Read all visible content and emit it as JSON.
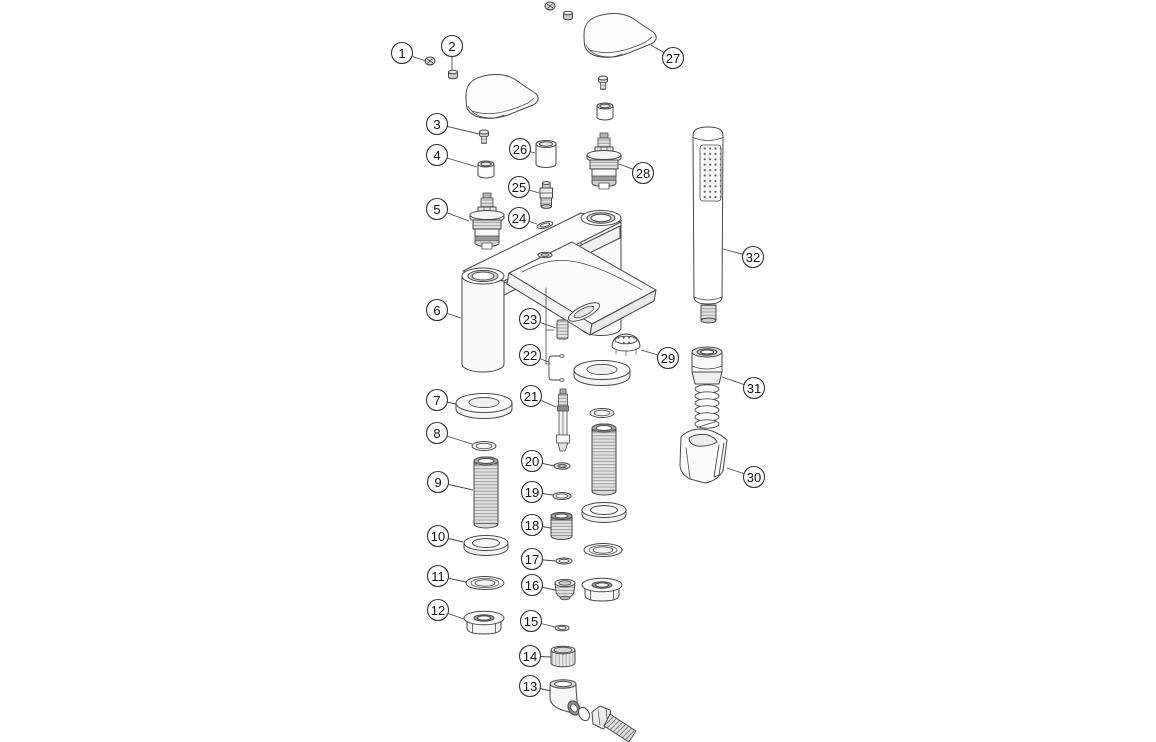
{
  "diagram": {
    "subject": "bath-shower-mixer-tap-exploded-parts-diagram",
    "background": "#ffffff",
    "line_color": "#474747",
    "callout_style": {
      "radius": 10.5,
      "fill": "#ffffff",
      "stroke": "#2e2e2e",
      "text_color": "#111111"
    },
    "callouts": [
      {
        "label": "1",
        "x": 402,
        "y": 53,
        "tx": 426,
        "ty": 61
      },
      {
        "label": "2",
        "x": 452,
        "y": 46,
        "tx": 452,
        "ty": 70
      },
      {
        "label": "3",
        "x": 437,
        "y": 124,
        "tx": 479,
        "ty": 134
      },
      {
        "label": "4",
        "x": 437,
        "y": 155,
        "tx": 477,
        "ty": 167
      },
      {
        "label": "5",
        "x": 437,
        "y": 209,
        "tx": 469,
        "ty": 221
      },
      {
        "label": "6",
        "x": 437,
        "y": 310,
        "tx": 461,
        "ty": 318
      },
      {
        "label": "7",
        "x": 437,
        "y": 400,
        "tx": 456,
        "ty": 404
      },
      {
        "label": "8",
        "x": 437,
        "y": 433,
        "tx": 472,
        "ty": 444
      },
      {
        "label": "9",
        "x": 438,
        "y": 482,
        "tx": 473,
        "ty": 490
      },
      {
        "label": "10",
        "x": 438,
        "y": 536,
        "tx": 463,
        "ty": 542
      },
      {
        "label": "11",
        "x": 438,
        "y": 576,
        "tx": 466,
        "ty": 582
      },
      {
        "label": "12",
        "x": 438,
        "y": 610,
        "tx": 464,
        "ty": 619
      },
      {
        "label": "13",
        "x": 530,
        "y": 686,
        "tx": 551,
        "ty": 691
      },
      {
        "label": "14",
        "x": 530,
        "y": 656,
        "tx": 551,
        "ty": 657
      },
      {
        "label": "15",
        "x": 531,
        "y": 621,
        "tx": 555,
        "ty": 627
      },
      {
        "label": "16",
        "x": 532,
        "y": 585,
        "tx": 555,
        "ty": 590
      },
      {
        "label": "17",
        "x": 532,
        "y": 559,
        "tx": 556,
        "ty": 561
      },
      {
        "label": "18",
        "x": 532,
        "y": 525,
        "tx": 551,
        "ty": 528
      },
      {
        "label": "19",
        "x": 532,
        "y": 492,
        "tx": 553,
        "ty": 495
      },
      {
        "label": "20",
        "x": 532,
        "y": 461,
        "tx": 554,
        "ty": 466
      },
      {
        "label": "21",
        "x": 531,
        "y": 396,
        "tx": 556,
        "ty": 407
      },
      {
        "label": "22",
        "x": 530,
        "y": 355,
        "tx": 549,
        "ty": 362
      },
      {
        "label": "23",
        "x": 530,
        "y": 319,
        "tx": 556,
        "ty": 328
      },
      {
        "label": "24",
        "x": 519,
        "y": 218,
        "tx": 537,
        "ty": 224
      },
      {
        "label": "25",
        "x": 519,
        "y": 187,
        "tx": 539,
        "ty": 193
      },
      {
        "label": "26",
        "x": 520,
        "y": 149,
        "tx": 535,
        "ty": 153
      },
      {
        "label": "27",
        "x": 673,
        "y": 58,
        "tx": 651,
        "ty": 45
      },
      {
        "label": "28",
        "x": 643,
        "y": 173,
        "tx": 619,
        "ty": 164
      },
      {
        "label": "29",
        "x": 668,
        "y": 358,
        "tx": 641,
        "ty": 350
      },
      {
        "label": "30",
        "x": 754,
        "y": 477,
        "tx": 727,
        "ty": 468
      },
      {
        "label": "31",
        "x": 754,
        "y": 388,
        "tx": 722,
        "ty": 377
      },
      {
        "label": "32",
        "x": 753,
        "y": 257,
        "tx": 723,
        "ty": 249
      }
    ],
    "parts": [
      {
        "callout": "1",
        "name": "grub-screw"
      },
      {
        "callout": "2",
        "name": "screw-bush"
      },
      {
        "callout": "3",
        "name": "handle-fixing-screw"
      },
      {
        "callout": "4",
        "name": "cartridge-cap"
      },
      {
        "callout": "5",
        "name": "ceramic-cartridge"
      },
      {
        "callout": "6",
        "name": "mixer-body"
      },
      {
        "callout": "7",
        "name": "base-washer"
      },
      {
        "callout": "8",
        "name": "o-ring"
      },
      {
        "callout": "9",
        "name": "threaded-shank"
      },
      {
        "callout": "10",
        "name": "rubber-washer"
      },
      {
        "callout": "11",
        "name": "flat-washer"
      },
      {
        "callout": "12",
        "name": "flanged-fixing-nut"
      },
      {
        "callout": "13",
        "name": "elbow-hose-tail"
      },
      {
        "callout": "14",
        "name": "cap-nut"
      },
      {
        "callout": "15",
        "name": "o-ring-small"
      },
      {
        "callout": "16",
        "name": "blanking-plug"
      },
      {
        "callout": "17",
        "name": "o-ring-small"
      },
      {
        "callout": "18",
        "name": "threaded-bush"
      },
      {
        "callout": "19",
        "name": "o-ring"
      },
      {
        "callout": "20",
        "name": "seal-ring"
      },
      {
        "callout": "21",
        "name": "diverter-rod"
      },
      {
        "callout": "22",
        "name": "retainer-clip"
      },
      {
        "callout": "23",
        "name": "spring"
      },
      {
        "callout": "24",
        "name": "o-ring-small"
      },
      {
        "callout": "25",
        "name": "non-return-valve"
      },
      {
        "callout": "26",
        "name": "valve-sleeve"
      },
      {
        "callout": "27",
        "name": "lever-handle"
      },
      {
        "callout": "28",
        "name": "ceramic-cartridge"
      },
      {
        "callout": "29",
        "name": "aerator"
      },
      {
        "callout": "30",
        "name": "wall-bracket"
      },
      {
        "callout": "31",
        "name": "shower-hose-connector"
      },
      {
        "callout": "32",
        "name": "shower-handset"
      }
    ]
  }
}
